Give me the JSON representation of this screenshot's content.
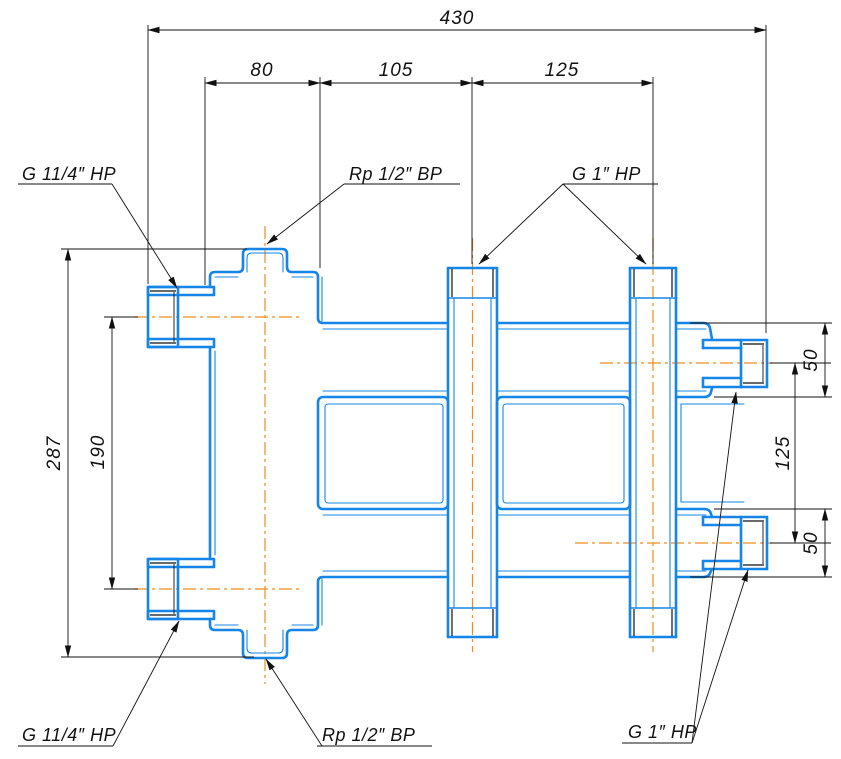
{
  "drawing": {
    "kind": "technical-drawing",
    "subject": "welded pipe manifold with threaded connections, front view with dimensions"
  },
  "colors": {
    "outline": "#1585E8",
    "centerline": "#F08C1E",
    "dimension": "#111111",
    "background": "#FFFFFF"
  },
  "dimensions": {
    "overall_width": "430",
    "body_width": "80",
    "pipe1_offset": "105",
    "pipe_spacing": "125",
    "overall_height": "287",
    "left_boss_spacing": "190",
    "top_chamber_height": "50",
    "right_boss_spacing": "125",
    "bottom_chamber_height": "50"
  },
  "connections": {
    "top_left_label": "G 11/4″ НР",
    "bottom_left_label": "G 11/4″ НР",
    "top_center_label": "Rp 1/2″ ВР",
    "bottom_center_label": "Rp 1/2″ ВР",
    "top_right_label": "G 1″ НР",
    "bottom_right_label": "G 1″ НР"
  }
}
